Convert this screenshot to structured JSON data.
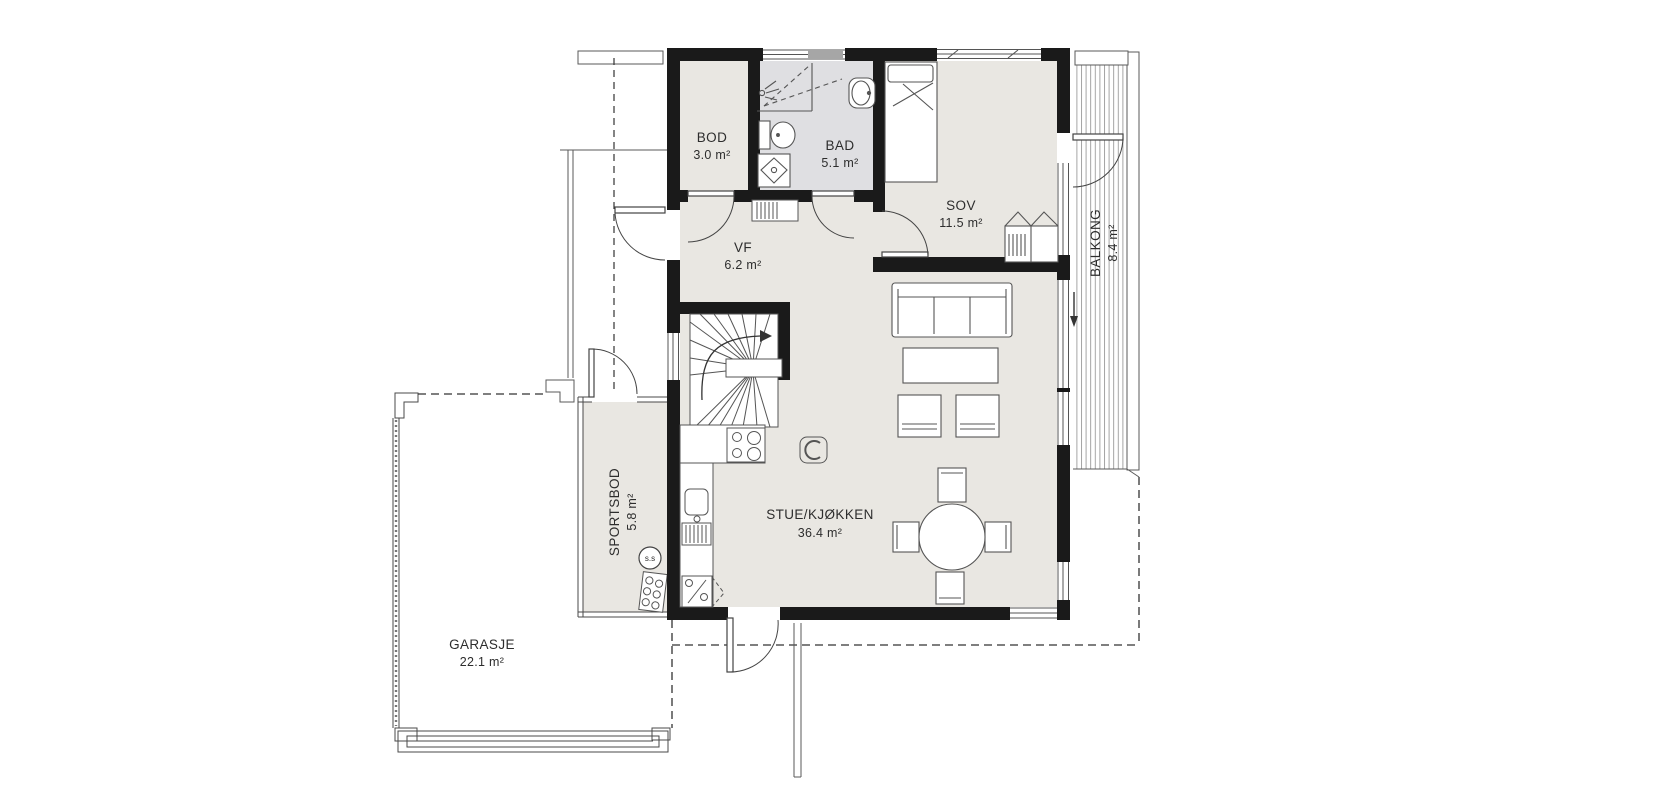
{
  "rooms": {
    "bod": {
      "name": "BOD",
      "area": "3.0 m²"
    },
    "bad": {
      "name": "BAD",
      "area": "5.1 m²"
    },
    "sov": {
      "name": "SOV",
      "area": "11.5 m²"
    },
    "vf": {
      "name": "VF",
      "area": "6.2 m²"
    },
    "stue": {
      "name": "STUE/KJØKKEN",
      "area": "36.4 m²"
    },
    "balkong": {
      "name": "BALKONG",
      "area": "8.4 m²"
    },
    "sportsbod": {
      "name": "SPORTSBOD",
      "area": "5.8 m²"
    },
    "garasje": {
      "name": "GARASJE",
      "area": "22.1 m²"
    }
  },
  "annotations": {
    "equipment_label": "s.s"
  },
  "colors": {
    "wall": "#1a1a1a",
    "floor": "#e9e7e2",
    "bathroom_floor": "#dfdfe2",
    "line": "#555555",
    "hatch": "#999999"
  }
}
